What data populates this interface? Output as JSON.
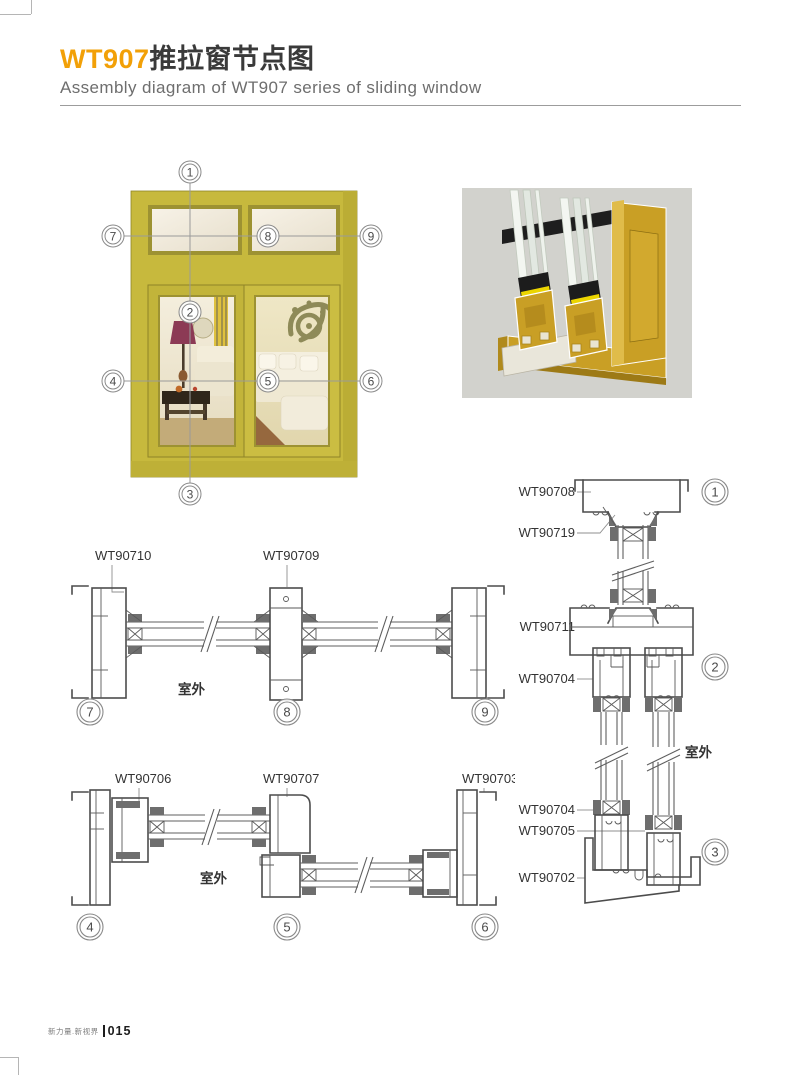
{
  "page": {
    "title_code": "WT907",
    "title_cn": "推拉窗节点图",
    "subtitle": "Assembly diagram of WT907 series of sliding window",
    "footer": {
      "brand": "新力量.新视界",
      "page_no": "015"
    }
  },
  "colors": {
    "accent_orange": "#F2A007",
    "frame_olive": "#C7B93D",
    "render_gold": "#C99F25",
    "render_background": "#D2D2CD",
    "drawing_stroke": "#4C4C4C"
  },
  "window_overview": {
    "callouts": [
      "1",
      "2",
      "3",
      "4",
      "5",
      "6",
      "7",
      "8",
      "9"
    ]
  },
  "detail_sections": {
    "horizontal_top": {
      "profile_labels": [
        "WT90710",
        "WT90709"
      ],
      "outdoor_label": "室外",
      "callouts": [
        "7",
        "8",
        "9"
      ]
    },
    "horizontal_bottom": {
      "profile_labels": [
        "WT90706",
        "WT90707",
        "WT90703"
      ],
      "outdoor_label": "室外",
      "callouts": [
        "4",
        "5",
        "6"
      ]
    },
    "vertical_right": {
      "profile_labels": [
        "WT90708",
        "WT90719",
        "WT90711",
        "WT90704",
        "WT90704",
        "WT90705",
        "WT90702"
      ],
      "outdoor_label": "室外",
      "callouts": [
        "1",
        "2",
        "3"
      ]
    }
  }
}
